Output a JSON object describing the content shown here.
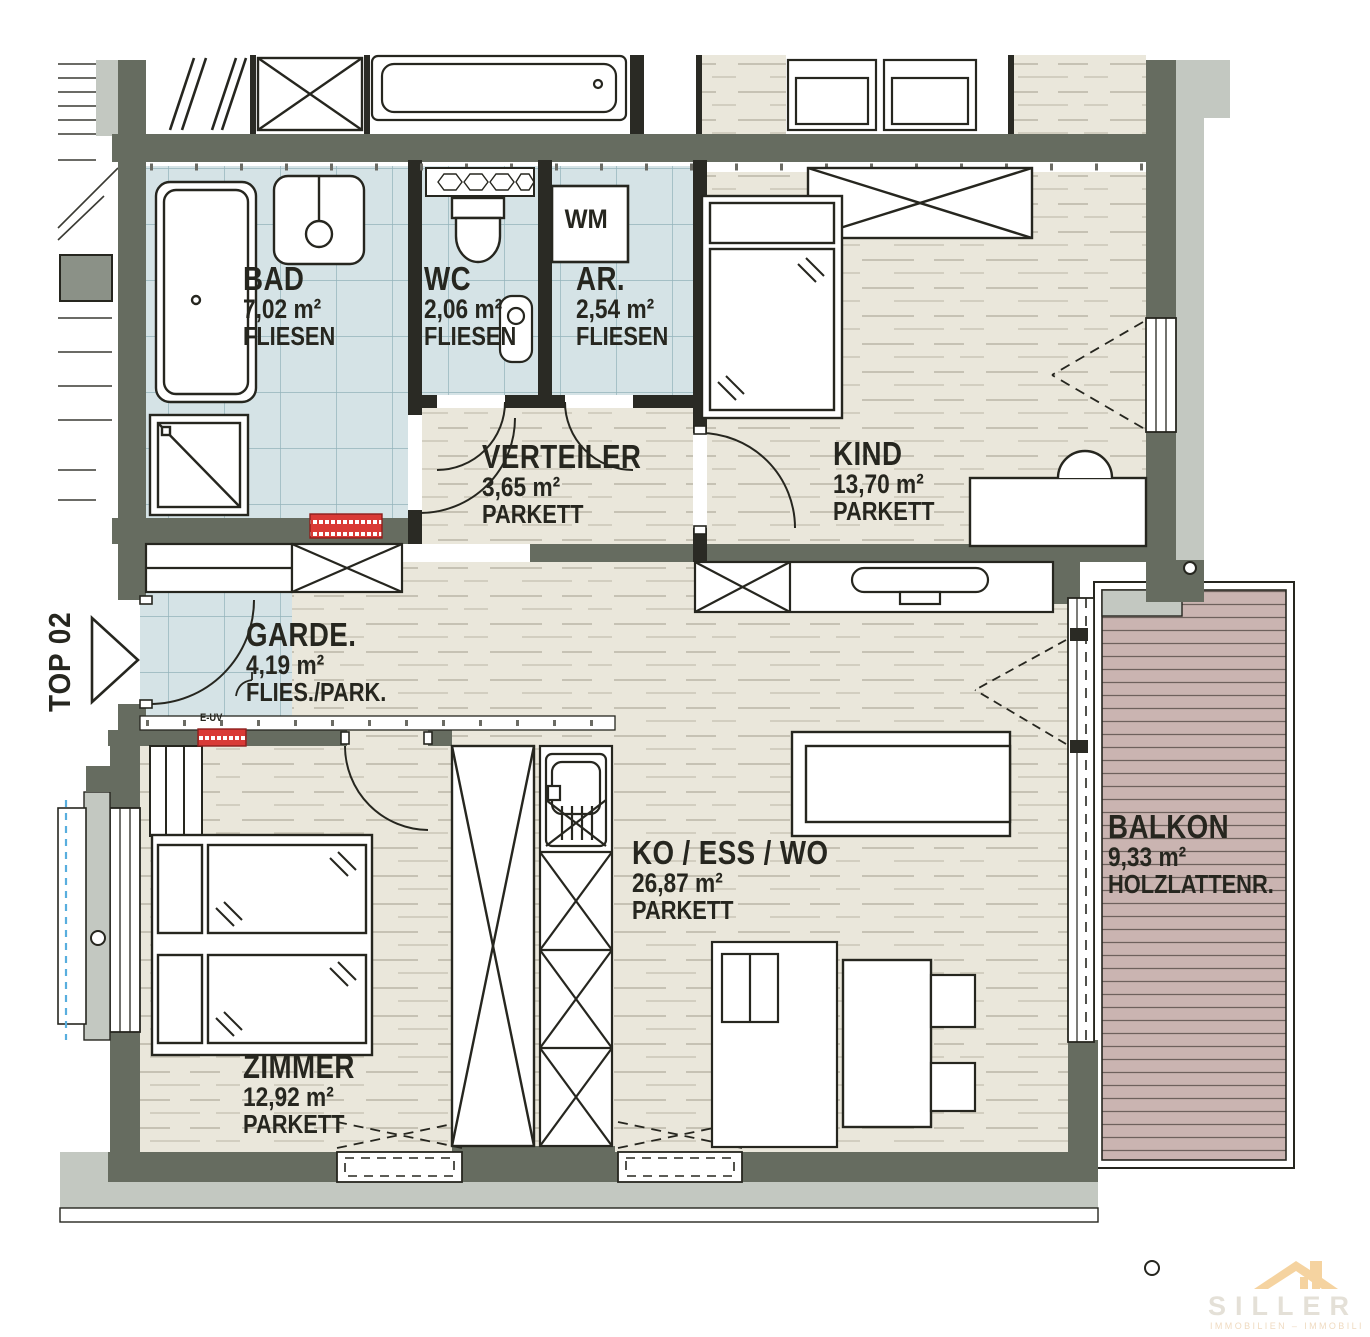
{
  "plan": {
    "unit_label": "TOP 02",
    "rooms": [
      {
        "id": "bad",
        "name": "BAD",
        "area": "7,02 m²",
        "floor": "FLIESEN"
      },
      {
        "id": "wc",
        "name": "WC",
        "area": "2,06 m²",
        "floor": "FLIESEN"
      },
      {
        "id": "ar",
        "name": "AR.",
        "area": "2,54 m²",
        "floor": "FLIESEN"
      },
      {
        "id": "kind",
        "name": "KIND",
        "area": "13,70 m²",
        "floor": "PARKETT"
      },
      {
        "id": "verteiler",
        "name": "VERTEILER",
        "area": "3,65 m²",
        "floor": "PARKETT"
      },
      {
        "id": "garde",
        "name": "GARDE.",
        "area": "4,19 m²",
        "floor": "FLIES./PARK."
      },
      {
        "id": "zimmer",
        "name": "ZIMMER",
        "area": "12,92 m²",
        "floor": "PARKETT"
      },
      {
        "id": "wohn",
        "name": "KO / ESS / WO",
        "area": "26,87 m²",
        "floor": "PARKETT"
      },
      {
        "id": "balkon",
        "name": "BALKON",
        "area": "9,33 m²",
        "floor": "HOLZLATTENR."
      }
    ],
    "markers": {
      "washing_machine": "WM",
      "electric_panel": "E-UV"
    },
    "colors": {
      "wall": "#666c60",
      "tile": "#d5e3e6",
      "parquet": "#eae7db",
      "balcony": "#cab4b1",
      "accent_red": "#d93a36"
    },
    "logo": {
      "name": "SILLER",
      "subtitle": "IMMOBILIEN – IMMOBILI"
    }
  }
}
